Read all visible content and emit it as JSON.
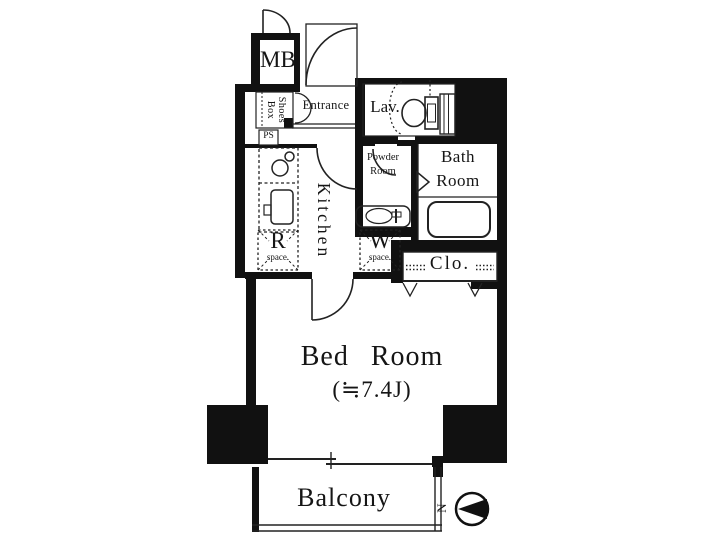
{
  "labels": {
    "mb": "MB",
    "shoes_box_line1": "Shoes",
    "shoes_box_line2": "Box",
    "ps": "PS",
    "entrance": "Entrance",
    "lav": "Lav.",
    "bath_line1": "Bath",
    "bath_line2": "Room",
    "powder_line1": "Powder",
    "powder_line2": "Room",
    "kitchen": "Kitchen",
    "r_label": "R",
    "r_sub": "space.",
    "w_label": "W",
    "w_sub": "space.",
    "closet": "Clo.",
    "bedroom_name": "Bed Room",
    "bedroom_size": "(≒7.4J)",
    "balcony": "Balcony",
    "compass_north": "N"
  },
  "colors": {
    "wall": "#111111",
    "line": "#222222",
    "background": "#ffffff"
  }
}
